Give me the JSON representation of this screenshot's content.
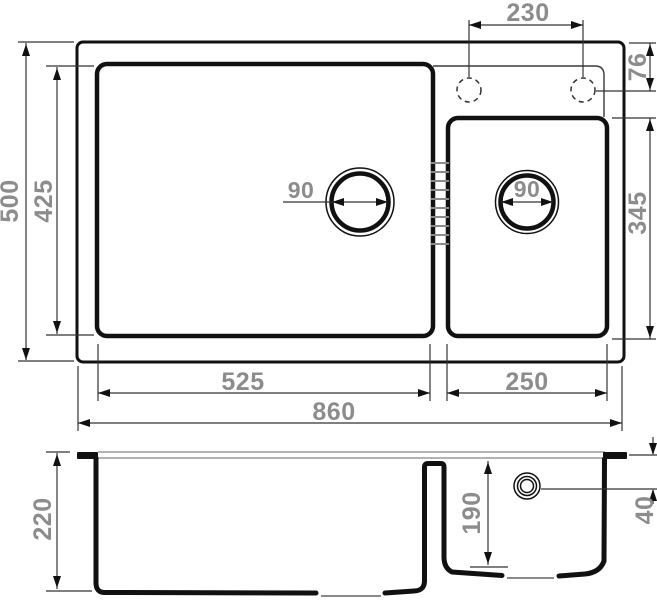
{
  "drawing": {
    "subject": "double-bowl sink dimensional drawing",
    "units": "mm",
    "colors": {
      "line": "#111111",
      "dim_text": "#8c8c8c",
      "hatch": "#8a8a8a"
    }
  },
  "top_view": {
    "dims": {
      "faucet_spacing": "230",
      "faucet_offset": "76",
      "small_bowl_length": "345",
      "overall_depth": "500",
      "inner_depth": "425",
      "main_drain_diameter": "90",
      "small_drain_diameter": "90",
      "main_bowl_width": "525",
      "small_bowl_width": "250",
      "overall_width": "860"
    }
  },
  "side_view": {
    "dims": {
      "overall_height": "220",
      "small_bowl_depth": "190",
      "overflow_offset": "40"
    }
  }
}
